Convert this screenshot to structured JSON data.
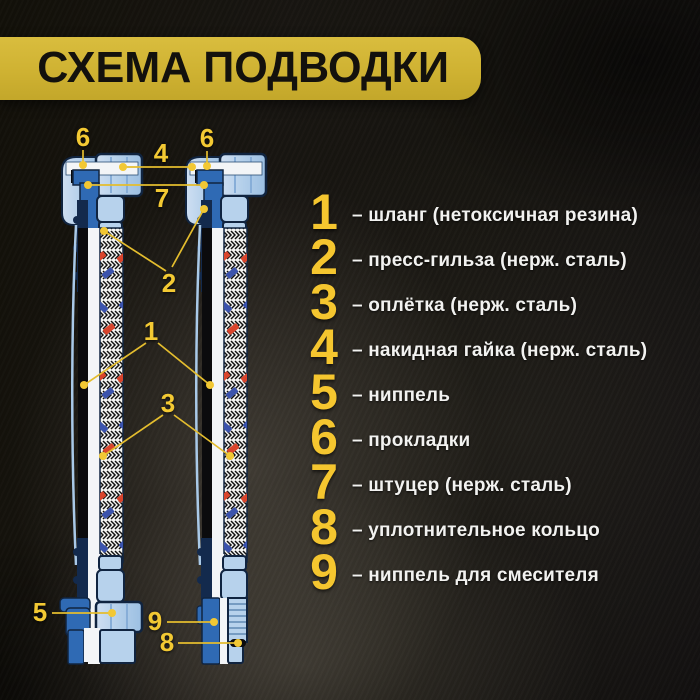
{
  "title": {
    "text": "СХЕМА ПОДВОДКИ"
  },
  "colors": {
    "banner_yellow": "#cfb232",
    "legend_number_yellow": "#f5c62f",
    "callout_yellow": "#f3c933",
    "steel_light_blue": "#b7d2ec",
    "steel_mid_blue": "#2f6ab4",
    "navy_outline": "#102440",
    "braid_red": "#d9442c",
    "braid_blue": "#3b53ad",
    "text_white": "#f2f2f0",
    "background_dark": "#14120e"
  },
  "diagram": {
    "labels": {
      "n1": "1",
      "n2": "2",
      "n3": "3",
      "n4": "4",
      "n5": "5",
      "n6": "6",
      "n7": "7",
      "n8": "8",
      "n9": "9"
    }
  },
  "legend": {
    "items": [
      {
        "num": "1",
        "text": "– шланг (нетоксичная резина)"
      },
      {
        "num": "2",
        "text": "– пресс-гильза (нерж. сталь)"
      },
      {
        "num": "3",
        "text": "– оплётка (нерж. сталь)"
      },
      {
        "num": "4",
        "text": "– накидная гайка (нерж. сталь)"
      },
      {
        "num": "5",
        "text": "– ниппель"
      },
      {
        "num": "6",
        "text": "– прокладки"
      },
      {
        "num": "7",
        "text": "– штуцер (нерж. сталь)"
      },
      {
        "num": "8",
        "text": "– уплотнительное кольцо"
      },
      {
        "num": "9",
        "text": "– ниппель для смесителя"
      }
    ]
  }
}
